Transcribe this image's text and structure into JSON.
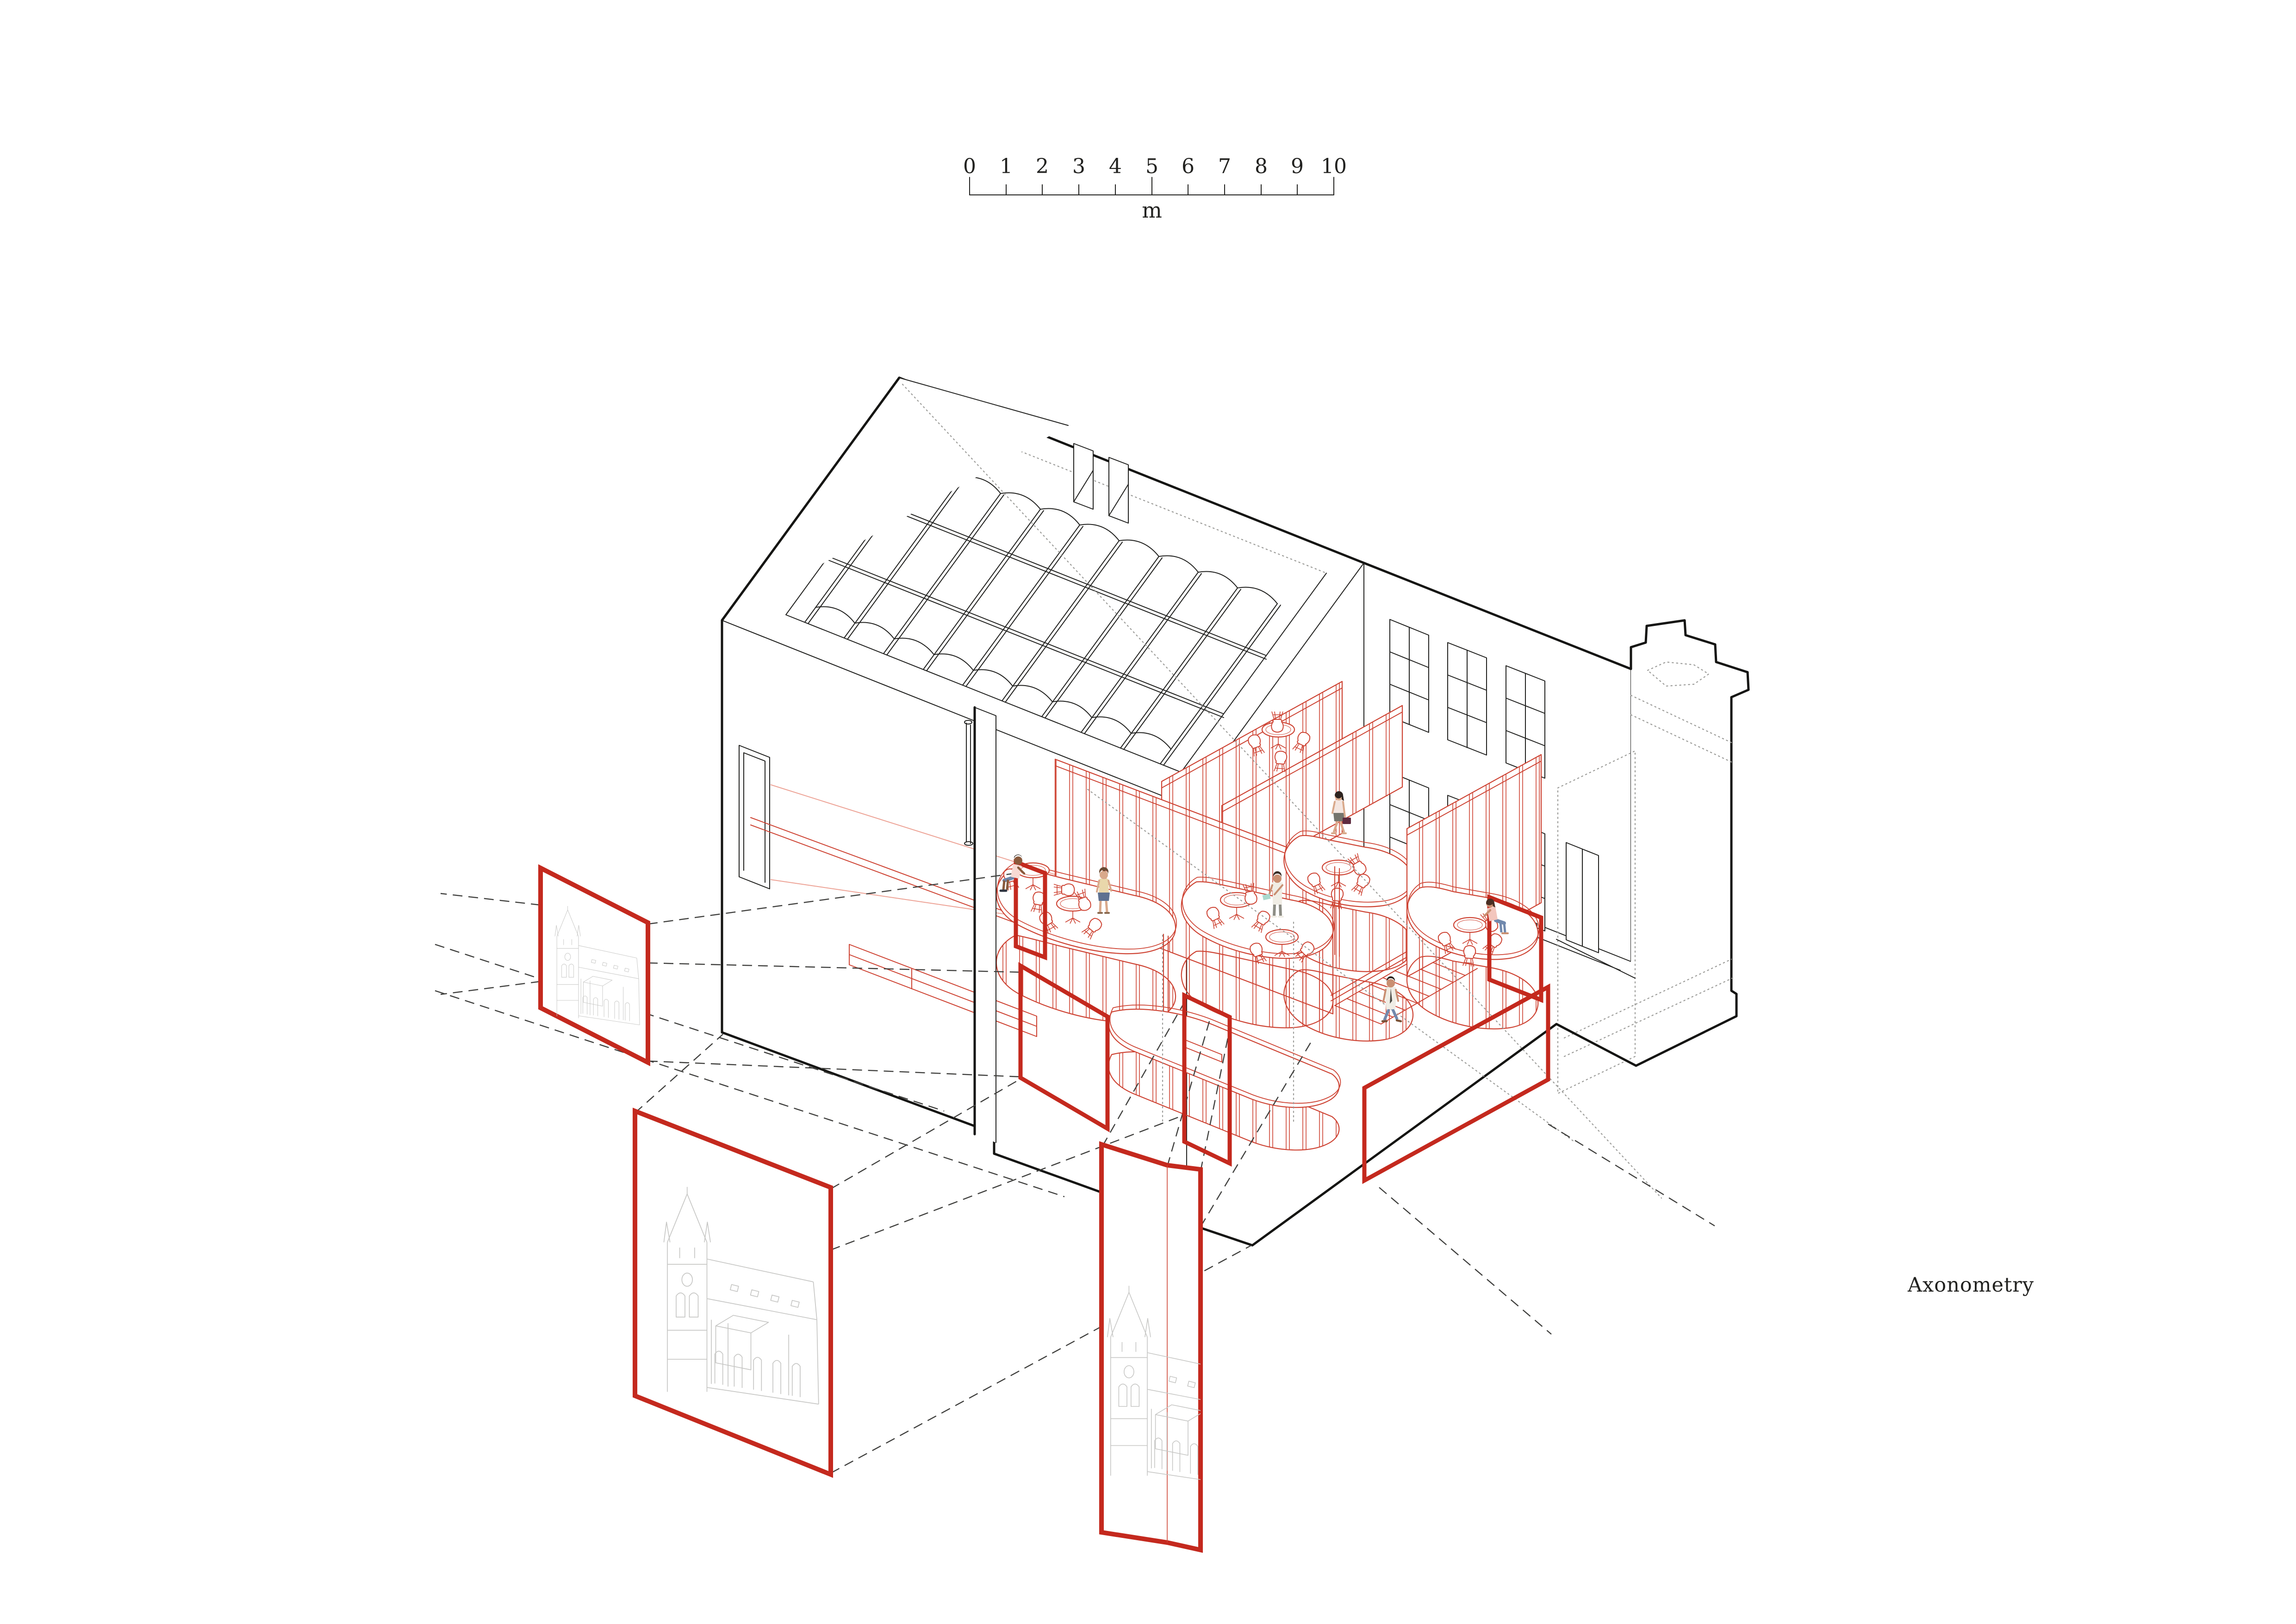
{
  "scale_bar": {
    "ticks": [
      "0",
      "1",
      "2",
      "3",
      "4",
      "5",
      "6",
      "7",
      "8",
      "9",
      "10"
    ],
    "unit": "m"
  },
  "caption": {
    "text": "Axonometry"
  },
  "palette": {
    "paper": "#ffffff",
    "ink": "#222220",
    "ink-heavy": "#151513",
    "red-frame": "#c4291e",
    "red-line": "#ce4434",
    "red-soft": "#eda396",
    "sketch": "#c7c7c5",
    "dash": "#3f3f3d",
    "dot": "#9c9c99"
  },
  "figures": [
    {
      "name": "seated-man-left-booth",
      "top": "#f7d9d3",
      "bottom": "#6f85a8",
      "skin": "#8a5a3c",
      "hair": "#26201c",
      "shoes": "#2e3440"
    },
    {
      "name": "standing-woman-left-booth",
      "top": "#e9d7ab",
      "bottom": "#5e7191",
      "skin": "#d9a98b",
      "hair": "#6b4a33",
      "shoes": "#8a6a50"
    },
    {
      "name": "man-reading-upper-deck",
      "top": "#f0ede5",
      "bottom": "#8d8d85",
      "skin": "#c98f71",
      "hair": "#3a2e26",
      "accessory": "#a9d9cd",
      "shoes": "#efece4"
    },
    {
      "name": "woman-briefcase-mezzanine",
      "top": "#f4e6e0",
      "bottom": "#75756d",
      "skin": "#d9a98b",
      "hair": "#2e2420",
      "accessory": "#5e2b3f",
      "shoes": "#d9a98b"
    },
    {
      "name": "seated-woman-right-booth",
      "top": "#f3c6bd",
      "bottom": "#7189ad",
      "skin": "#c98f71",
      "hair": "#4a2f24",
      "accessory": "#bfe3d9",
      "shoes": "#c98f71"
    },
    {
      "name": "walking-man-courtyard",
      "top": "#f0ede5",
      "bottom": "#7189ad",
      "skin": "#c98f71",
      "hair": "#26201c",
      "accessory": "#4a4a44",
      "shoes": "#7a5236"
    }
  ],
  "panels": [
    {
      "name": "upper-left",
      "content": "church elevation sketch"
    },
    {
      "name": "lower-left",
      "content": "church elevation sketch"
    },
    {
      "name": "bottom-center",
      "content": "church elevation sketch"
    }
  ]
}
